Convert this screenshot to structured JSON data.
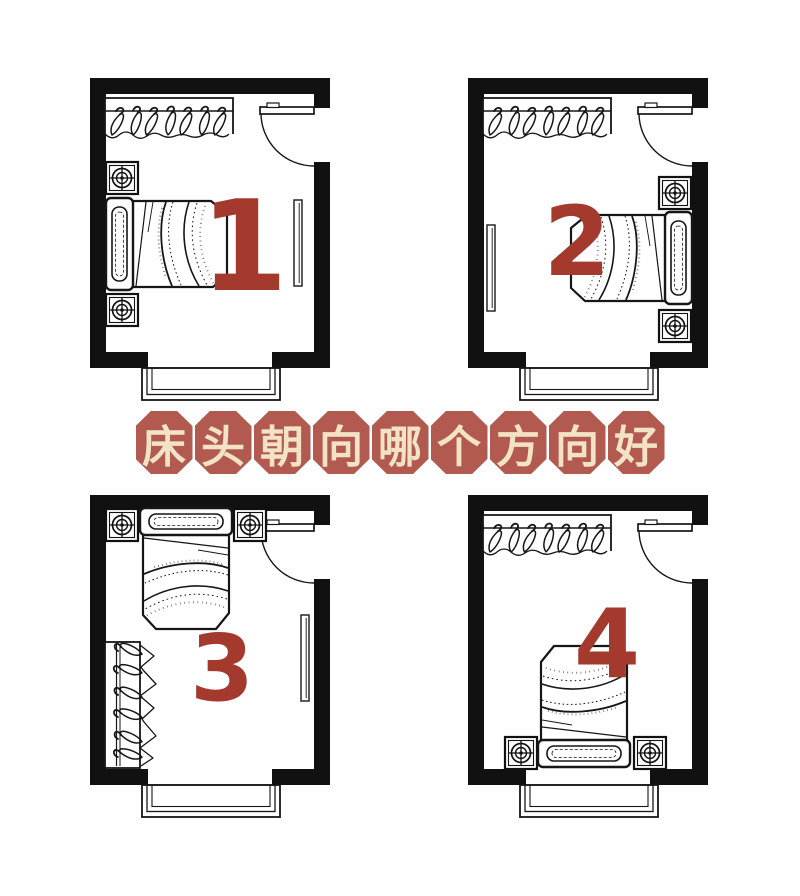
{
  "meta": {
    "title": "床头朝向哪个方向好"
  },
  "banner": {
    "text": "床头朝向哪个方向好",
    "chars": [
      "床",
      "头",
      "朝",
      "向",
      "哪",
      "个",
      "方",
      "向",
      "好"
    ],
    "tile_color": "#b25a4f",
    "text_color": "#f2e3c7"
  },
  "rooms": [
    {
      "number": "1"
    },
    {
      "number": "2"
    },
    {
      "number": "3"
    },
    {
      "number": "4"
    }
  ],
  "colors": {
    "background": "#ffffff",
    "wall": "#111111",
    "line": "#161616",
    "number_red": "#a43a2e"
  }
}
